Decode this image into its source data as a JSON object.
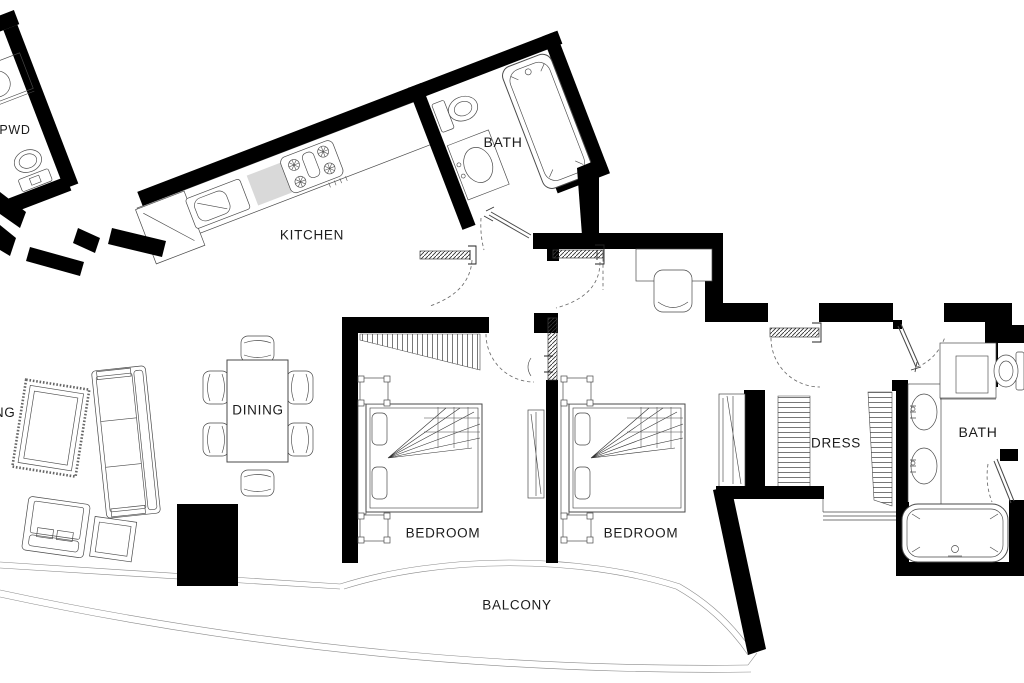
{
  "rooms": {
    "pwd": "PWD",
    "kitchen": "KITCHEN",
    "bath_top": "BATH",
    "dining": "DINING",
    "living": "LIVING",
    "bedroom_1": "BEDROOM",
    "bedroom_2": "BEDROOM",
    "dress": "DRESS",
    "bath_master": "BATH",
    "balcony": "BALCONY"
  },
  "colors": {
    "wall": "#000000",
    "outline": "#4a4a4a",
    "light_line": "#8a8a8a",
    "counter_fill": "#d9d9d9",
    "text": "#1c1c1c",
    "background": "#ffffff"
  },
  "symbols": [
    "bathtub",
    "toilet",
    "sink",
    "double-vanity",
    "shower",
    "kitchen-counter",
    "stove",
    "refrigerator",
    "dining-table",
    "chair",
    "sofa",
    "armchair",
    "rug",
    "side-table",
    "double-bed",
    "nightstand",
    "wardrobe",
    "dresser",
    "desk",
    "door-swing",
    "sliding-door",
    "balcony-railing",
    "service-shaft"
  ]
}
